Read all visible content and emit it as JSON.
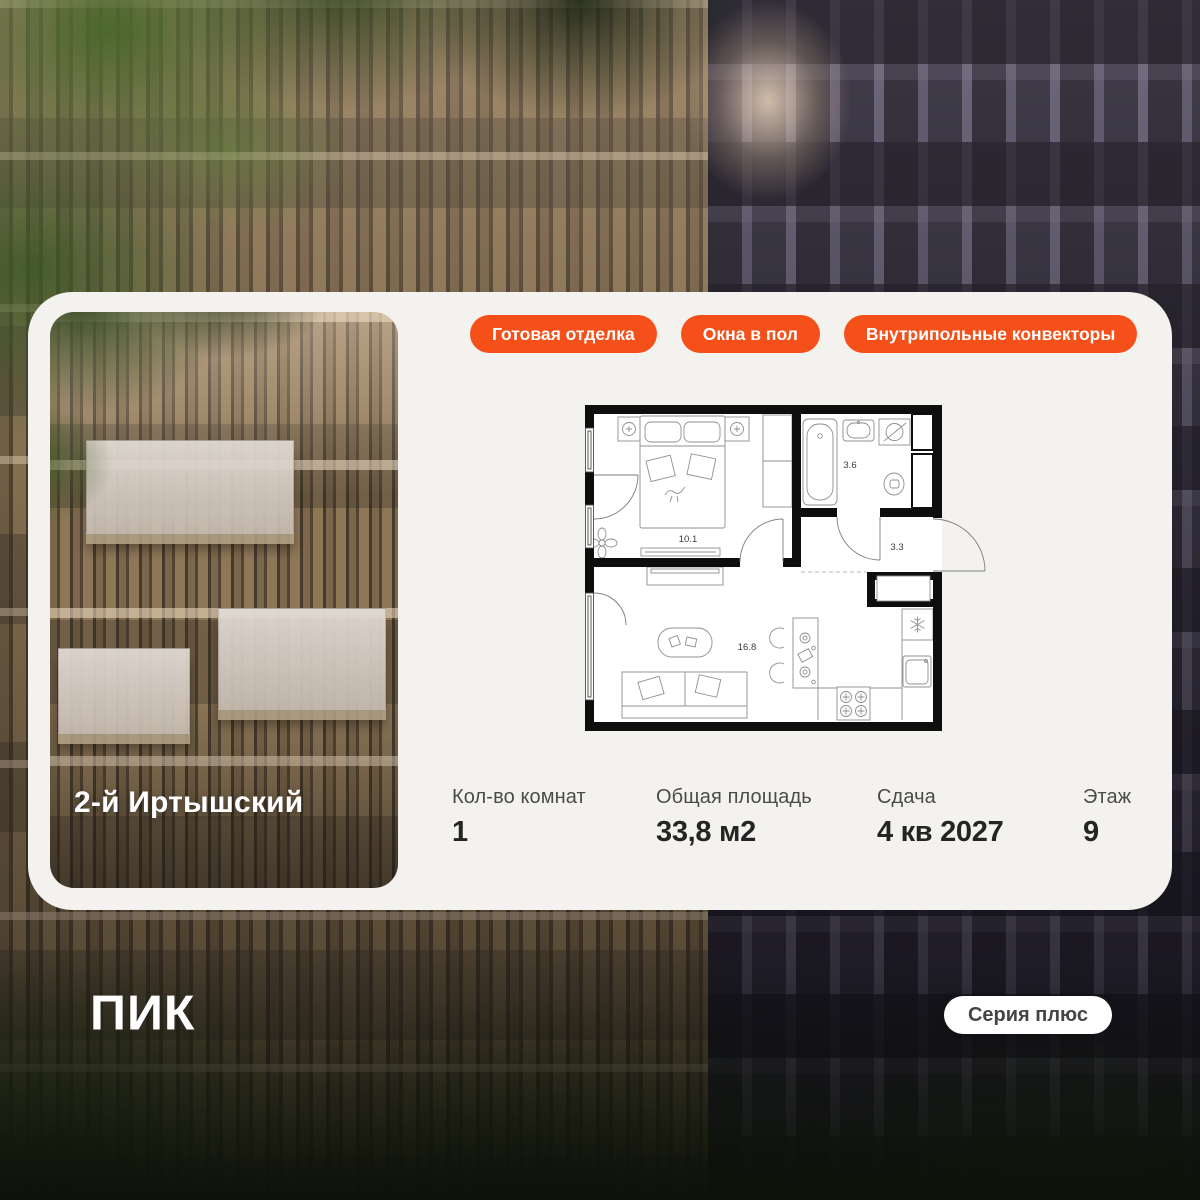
{
  "colors": {
    "accent": "#F5501A",
    "card_background": "#F4F2EF"
  },
  "card": {
    "badges": [
      {
        "label": "Готовая отделка"
      },
      {
        "label": "Окна в пол"
      },
      {
        "label": "Внутрипольные конвекторы"
      }
    ],
    "photo": {
      "project_name": "2-й Иртышский"
    },
    "floorplan": {
      "rooms": [
        {
          "name": "bedroom",
          "area_label": "10.1"
        },
        {
          "name": "bathroom",
          "area_label": "3.6"
        },
        {
          "name": "hallway",
          "area_label": "3.3"
        },
        {
          "name": "living-kitchen",
          "area_label": "16.8"
        }
      ]
    },
    "stats": [
      {
        "label": "Кол-во комнат",
        "value": "1"
      },
      {
        "label": "Общая площадь",
        "value": "33,8 м2"
      },
      {
        "label": "Сдача",
        "value": "4 кв 2027"
      },
      {
        "label": "Этаж",
        "value": "9"
      }
    ]
  },
  "footer": {
    "logo_text": "ПИК",
    "series_badge": "Серия плюс"
  }
}
